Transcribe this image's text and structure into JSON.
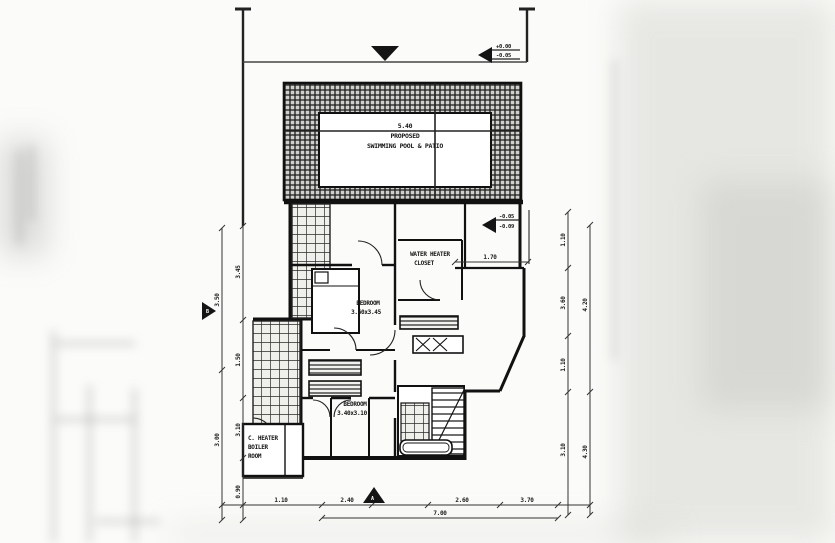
{
  "plan": {
    "pool": {
      "dim": "5.40",
      "label_line1": "PROPOSED",
      "label_line2": "SWIMMING POOL & PATIO"
    },
    "rooms": {
      "water_heater": {
        "line1": "WATER HEATER",
        "line2": "CLOSET"
      },
      "bedroom_upper": {
        "line1": "BEDROOM",
        "line2": "3.60x3.45"
      },
      "bedroom_lower": {
        "line1": "BEDROOM",
        "line2": "3.40x3.10"
      },
      "boiler": {
        "line1": "C. HEATER",
        "line2": "BOILER",
        "line3": "ROOM"
      }
    },
    "spot_levels": {
      "top_right": {
        "v1": "+0.00",
        "v2": "-0.05"
      },
      "mid_right": {
        "v1": "-0.05",
        "v2": "-0.09"
      }
    },
    "dims": {
      "bay_width": "1.70",
      "bottom": {
        "s1": "1.10",
        "s2": "2.40",
        "s3": "2.60",
        "s4": "3.70",
        "total": "7.00"
      },
      "left_inner": {
        "s1": "3.45",
        "s2": "1.50",
        "s3": "3.10",
        "s4": "0.90"
      },
      "left_outer": {
        "s1": "3.50",
        "s2": "3.00"
      },
      "right_inner": {
        "s1": "1.10",
        "s2": "3.60",
        "s3": "1.10",
        "s4": "3.10"
      },
      "right_outer": {
        "s1": "4.20",
        "s2": "4.30"
      }
    },
    "markers": {
      "section_bottom": "A",
      "section_left": "B"
    }
  }
}
